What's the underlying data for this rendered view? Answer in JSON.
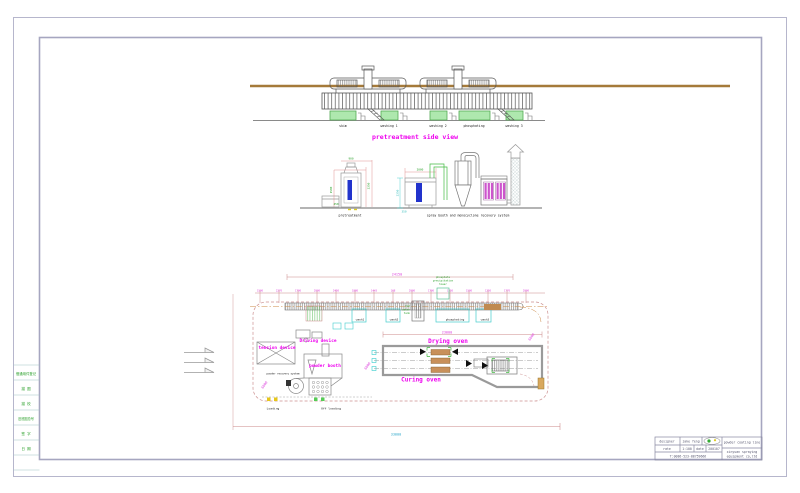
{
  "sheet": {
    "bg": "#ffffff",
    "frame_color": "#b6b6cc"
  },
  "side_view": {
    "title": "pretreatment side view",
    "tank_labels": [
      "skim",
      "washing 1",
      "washing 2",
      "phosphating",
      "washing 3"
    ]
  },
  "details": {
    "pretreatment_label": "pretreatment",
    "spray_label": "spray booth and monocyclone recovery system",
    "pre_dims": {
      "top": "900",
      "right": "2350",
      "left": "1500",
      "bottom": "450"
    },
    "spray_dims": {
      "top": "2000",
      "left": "2350",
      "bottom": "350"
    }
  },
  "plan": {
    "total_dim_top": "24150",
    "oven_dim": "23000",
    "bottom_dim": "33000",
    "rotated_dims": [
      "6000",
      "6000",
      "6000"
    ],
    "dims_top": [
      "1500",
      "2270",
      "1700",
      "2000",
      "2450",
      "1880",
      "1443",
      "168",
      "2000",
      "1700",
      "1750",
      "1500",
      "1250",
      "1770",
      "2000"
    ],
    "tank_labels": [
      "wash1",
      "wash2",
      "phosphating",
      "wash3"
    ],
    "tower_lines": [
      "phosphate",
      "precipitation",
      "tower"
    ],
    "hot_tank_lines": [
      "hot",
      "water",
      "tank"
    ],
    "labels": {
      "driving_device": "Driving device",
      "tension_device": "tension device",
      "powder_booth": "powder booth",
      "powder_recovery": "powder recovery system",
      "drying_oven": "Drying oven",
      "curing_oven": "Curing oven",
      "loading": "Loading",
      "offloading": "Off loading"
    }
  },
  "title_block": {
    "designer_label": "designer",
    "designer_value": "jake feng",
    "rate_label": "rate",
    "rate_value": "1:100",
    "date_label": "date",
    "date_value": "200107",
    "phone": "T:0086-523-88759666",
    "product": "powder coating line",
    "company_line1": "xinyuan spraying",
    "company_line2": "equipment co,ltd"
  },
  "border_table": {
    "rows": [
      "借通用件登记",
      "描 图",
      "描 校",
      "旧底图总号",
      "签 字",
      "日 期"
    ]
  }
}
